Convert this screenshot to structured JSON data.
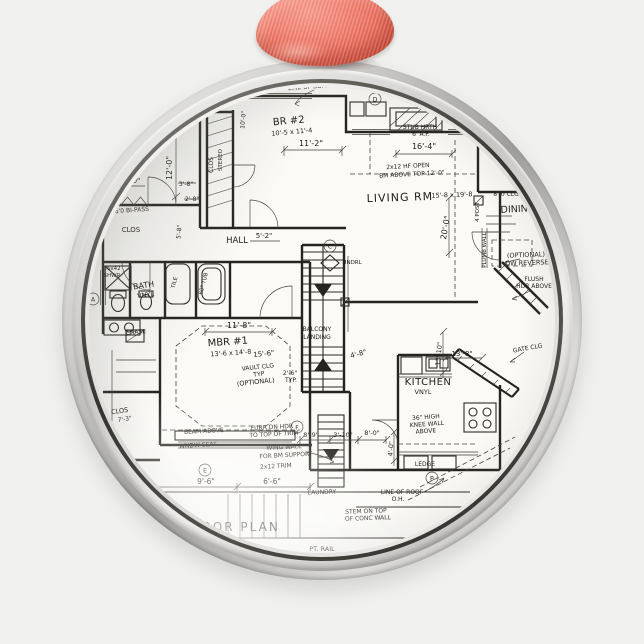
{
  "scene": {
    "background_color": "#f0f0ee",
    "ornament": {
      "shape": "round metal ornament",
      "outer_silver": "#d8d8d6",
      "dark_ring": "#36342f",
      "inner_silver": "#eceae8"
    },
    "ribbon": {
      "base": "#ec6f5e",
      "highlight": "#f89c8d",
      "shadow": "#c74c3c"
    },
    "paper": {
      "color": "#fbfaf7",
      "ink": "#26241f"
    }
  },
  "floor_plan": {
    "labels": [
      "LINE OF SOFFIT CUT",
      "BR #2",
      "10'-5 x 11'-4",
      "11'-2\"",
      "12'-0\"",
      "8'-0\"",
      "STUB HRTH",
      "6' A.F.",
      "16'-4\"",
      "2x12 HF OPEN",
      "BM ABOVE TOP 12'-0\"",
      "LIVING RM",
      "15'-8 x 19'-8",
      "20'-0\"",
      "6'0 BI-PASS",
      "CLOS",
      "HALL",
      "5'-2\"",
      "DINING",
      "8'-0 CLG",
      "(OPTIONAL)",
      "DW REVERSE",
      "FLUSH",
      "HDR ABOVE",
      "BATH",
      "VNYL",
      "36x42",
      "SHWR",
      "60\" TUB",
      "TILE",
      "CHASE",
      "A",
      "HNDRL",
      "BALCONY",
      "LANDING",
      "11'-8\"",
      "MBR #1",
      "13'-6 x 14'-8",
      "15'-6\"",
      "VAULT CLG",
      "TYP",
      "(OPTIONAL)",
      "2'-6\"",
      "TYP.",
      "4'-8\"",
      "KITCHEN",
      "VNYL",
      "36\" HIGH",
      "KNEE WALL",
      "ABOVE",
      "LEDGE",
      "13'-10\"",
      "13'-8\"",
      "GATE CLG",
      "BEAM ABOVE",
      "WNDW SEAT",
      "FURR DN HDR",
      "TO TOP OF TRIM",
      "WING WALL",
      "FOR BM SUPPORT",
      "2x12 TRIM",
      "E",
      "9'-6\"",
      "6'-6\"",
      "LAUNDRY",
      "8'-9\"",
      "3'-10\"",
      "8'-0\"",
      "4'-0\"",
      "LINE OF ROOF",
      "O.H.",
      "STEM ON TOP",
      "OF CONC WALL",
      "PT. RAIL",
      "FLOOR PLAN",
      "CLOS",
      "7'-3\"",
      "C",
      "D",
      "F",
      "B",
      "3'-8\"",
      "2'-8\"",
      "5'-8\"",
      "CLOS",
      "STEREO",
      "10'-0\"",
      "4 POST",
      "PLUMB WALL"
    ]
  }
}
